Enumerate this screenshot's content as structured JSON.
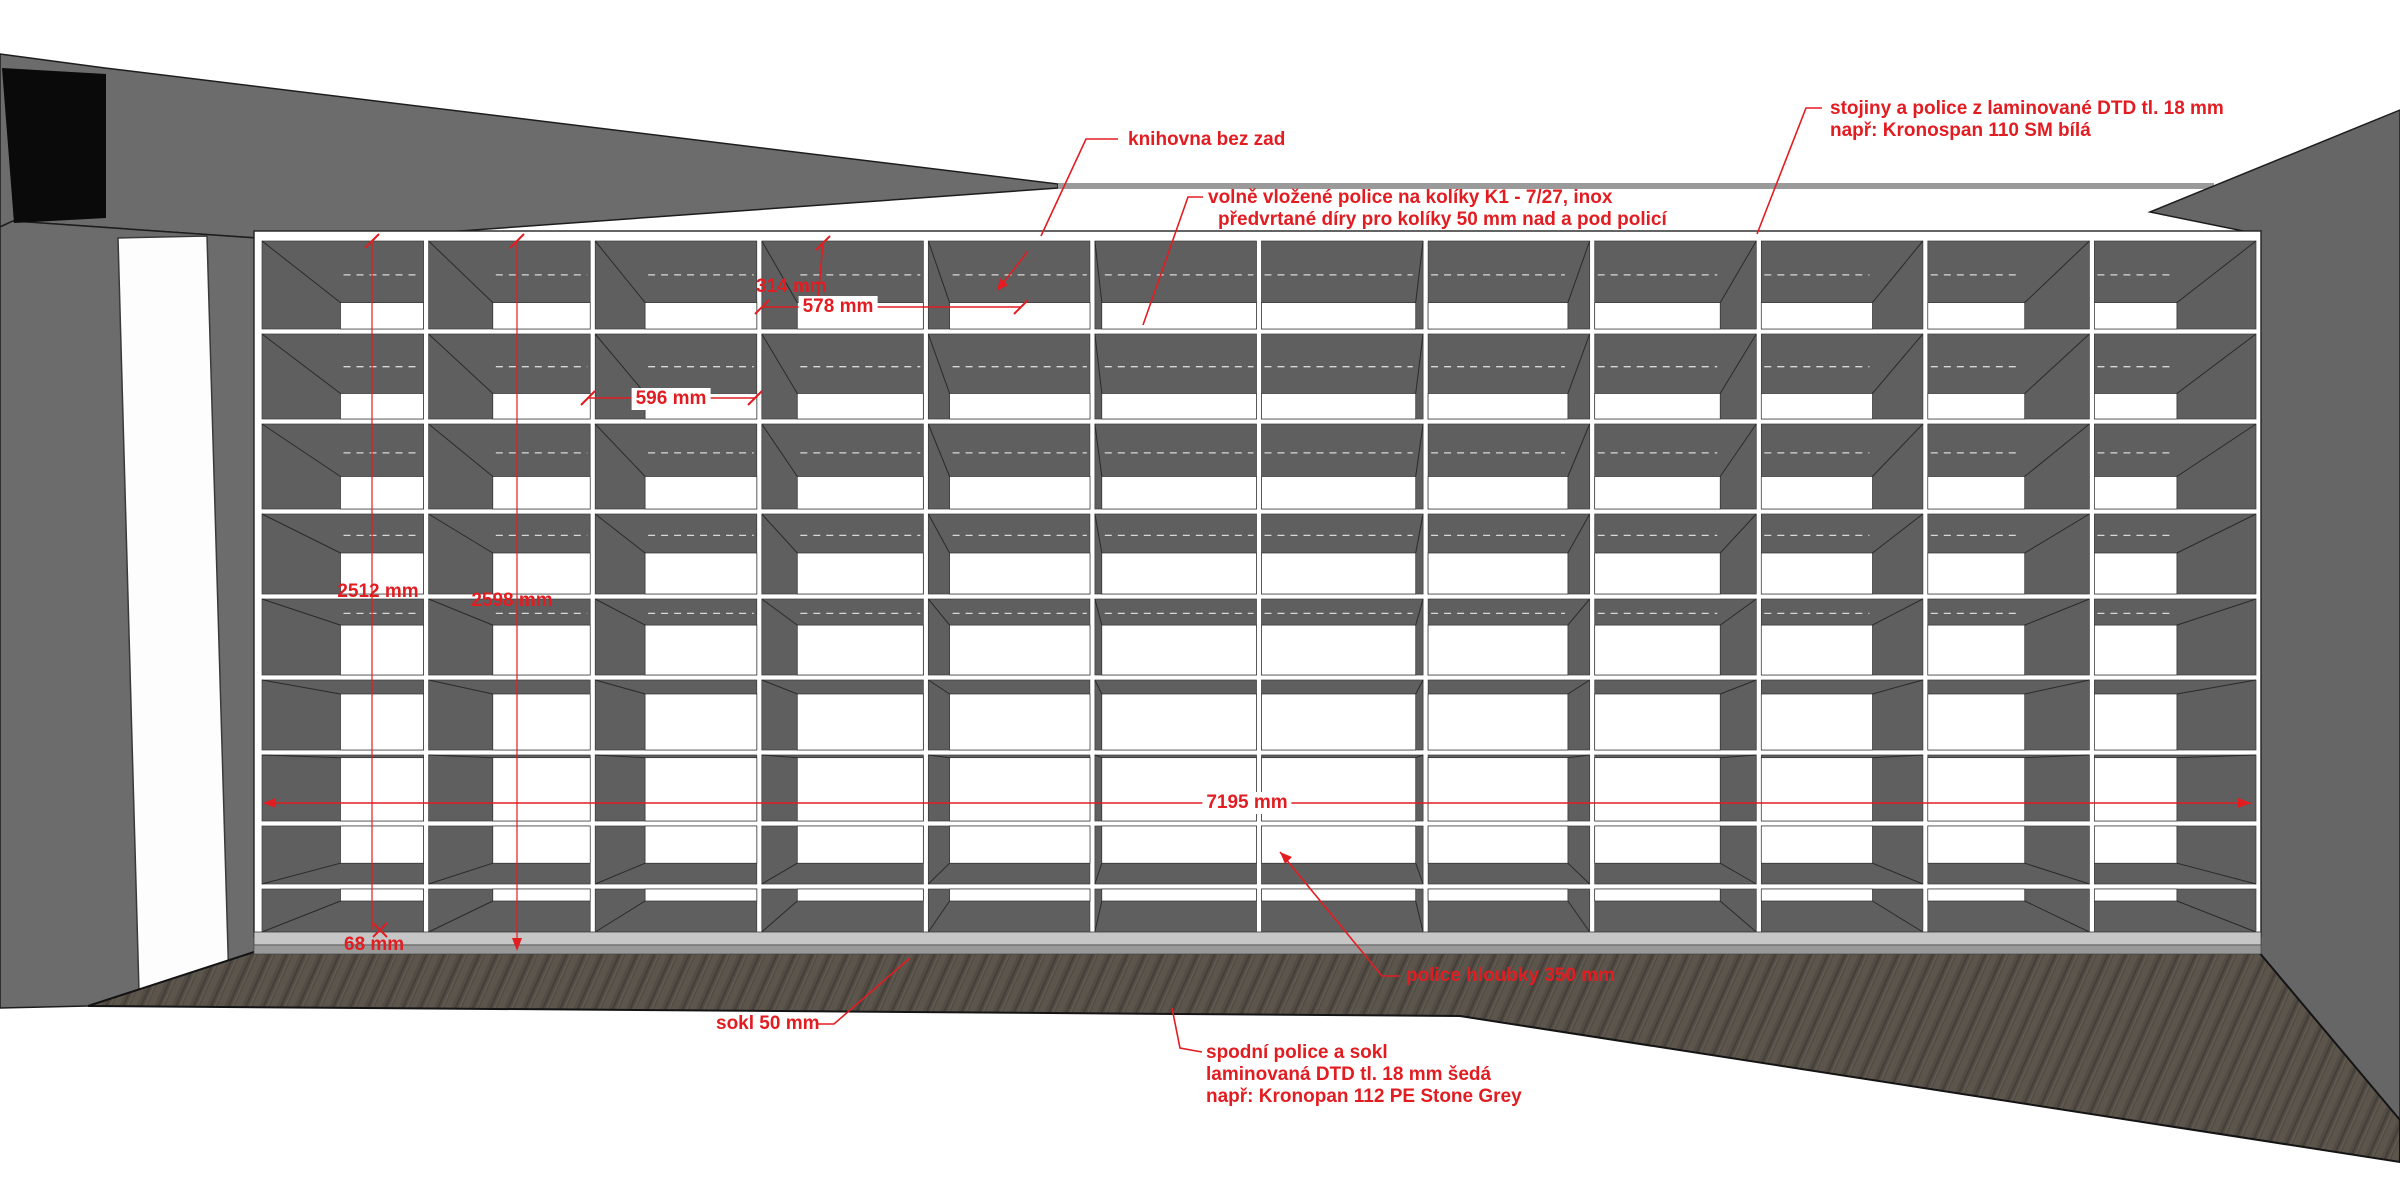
{
  "drawing": {
    "subject": "knihovna (bookshelf wall) elevation",
    "colors": {
      "annotation_red": "#e21d22",
      "wall_gray": "#6c6c6c",
      "cell_interior_gray": "#5f5f5f",
      "board_white": "#ffffff",
      "stone_grey_sokl": "#c6c6c6",
      "floor_brown": "#524c45",
      "black_opening": "#0a0a0a"
    },
    "shelf": {
      "columns": 12,
      "rows": 9,
      "board_thickness_mm": 18,
      "no_back_panel": true
    }
  },
  "labels": {
    "knihovna": {
      "text": "knihovna bez zad"
    },
    "stojiny": {
      "line1": "stojiny a police z laminované DTD tl. 18 mm",
      "line2": "např: Kronospan 110 SM bílá"
    },
    "vlozene": {
      "line1": "volně vložené police na kolíky K1 - 7/27, inox",
      "line2": "předvrtané díry pro kolíky 50 mm nad a pod policí"
    },
    "sokl": {
      "text": "sokl 50 mm"
    },
    "hloubka": {
      "text": "police hloubky 350 mm"
    },
    "spodni": {
      "line1": "spodní police a sokl",
      "line2": "laminovaná DTD tl. 18 mm šedá",
      "line3": "např: Kronopan 112 PE Stone Grey"
    }
  },
  "dimensions": {
    "d314": "314 mm",
    "d578": "578 mm",
    "d596": "596 mm",
    "d2512": "2512 mm",
    "d2598": "2598 mm",
    "d7195": "7195 mm",
    "d68": "68 mm"
  }
}
